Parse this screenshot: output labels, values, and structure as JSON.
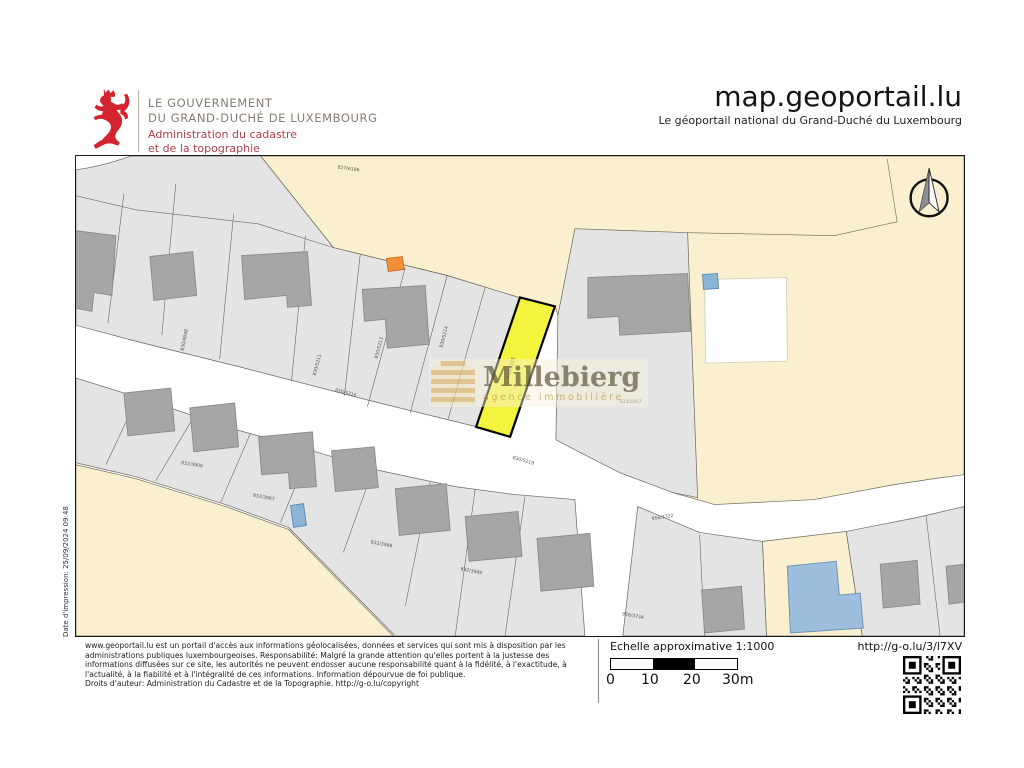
{
  "header": {
    "gov_line1": "LE GOUVERNEMENT",
    "gov_line2": "DU GRAND-DUCHÉ DE LUXEMBOURG",
    "admin_line1": "Administration du cadastre",
    "admin_line2": "et de la topographie",
    "site_title": "map.geoportail.lu",
    "site_subtitle": "Le géoportail national du Grand-Duché du Luxembourg"
  },
  "map": {
    "date_caption": "Date d'impression: 25/09/2024 09:48",
    "watermark": {
      "name": "Millebierg",
      "tagline": "agence immobilière"
    },
    "parcel_labels": [
      {
        "text": "827/6186",
        "x": 273,
        "y": 14,
        "r": 8
      },
      {
        "text": "830/4848",
        "x": 110,
        "y": 185,
        "r": -78
      },
      {
        "text": "830/5211",
        "x": 243,
        "y": 210,
        "r": -75
      },
      {
        "text": "830/5213",
        "x": 305,
        "y": 193,
        "r": -75
      },
      {
        "text": "830/5214",
        "x": 370,
        "y": 182,
        "r": -75
      },
      {
        "text": "830/5215",
        "x": 437,
        "y": 213,
        "r": -74
      },
      {
        "text": "830/5216",
        "x": 270,
        "y": 239,
        "r": 14
      },
      {
        "text": "830/5218",
        "x": 448,
        "y": 307,
        "r": 16
      },
      {
        "text": "831/5057",
        "x": 556,
        "y": 248,
        "r": 0
      },
      {
        "text": "832/3906",
        "x": 116,
        "y": 311,
        "r": 9
      },
      {
        "text": "832/3967",
        "x": 188,
        "y": 344,
        "r": 10
      },
      {
        "text": "832/3988",
        "x": 306,
        "y": 391,
        "r": 11
      },
      {
        "text": "832/3989",
        "x": 396,
        "y": 418,
        "r": 12
      },
      {
        "text": "956/3722",
        "x": 588,
        "y": 364,
        "r": -9
      },
      {
        "text": "956/3734",
        "x": 558,
        "y": 463,
        "r": 10
      }
    ],
    "colors": {
      "highlight_yellow": "#f2f43d",
      "cream_parcel": "#faf0cf",
      "gray_parcel": "#e4e4e4",
      "building_gray": "#a6a6a6",
      "building_blue": "#9dbfdd",
      "accent_blue": "#8cb4d6",
      "accent_orange": "#f0913a",
      "brand_red": "#d2232e"
    }
  },
  "footer": {
    "disclaimer_lines": [
      "www.geoportail.lu est un portail d'accès aux informations géolocalisées, données et services qui sont mis à disposition par les",
      "administrations publiques luxembourgeoises. Responsabilité: Malgré la grande attention qu'elles portent à la justesse des",
      "informations diffusées sur ce site, les autorités ne peuvent endosser aucune responsabilité quant à la fidélité, à l'exactitude, à",
      "l'actualité, à la fiabilité et à l'intégralité de ces informations. Information dépourvue de foi publique.",
      "Droits d'auteur: Administration du Cadastre et de la Topographie. http://g-o.lu/copyright"
    ],
    "scale_label": "Echelle approximative 1:1000",
    "scale_ticks": [
      "0",
      "10",
      "20",
      "30m"
    ],
    "short_url": "http://g-o.lu/3/l7XV"
  }
}
